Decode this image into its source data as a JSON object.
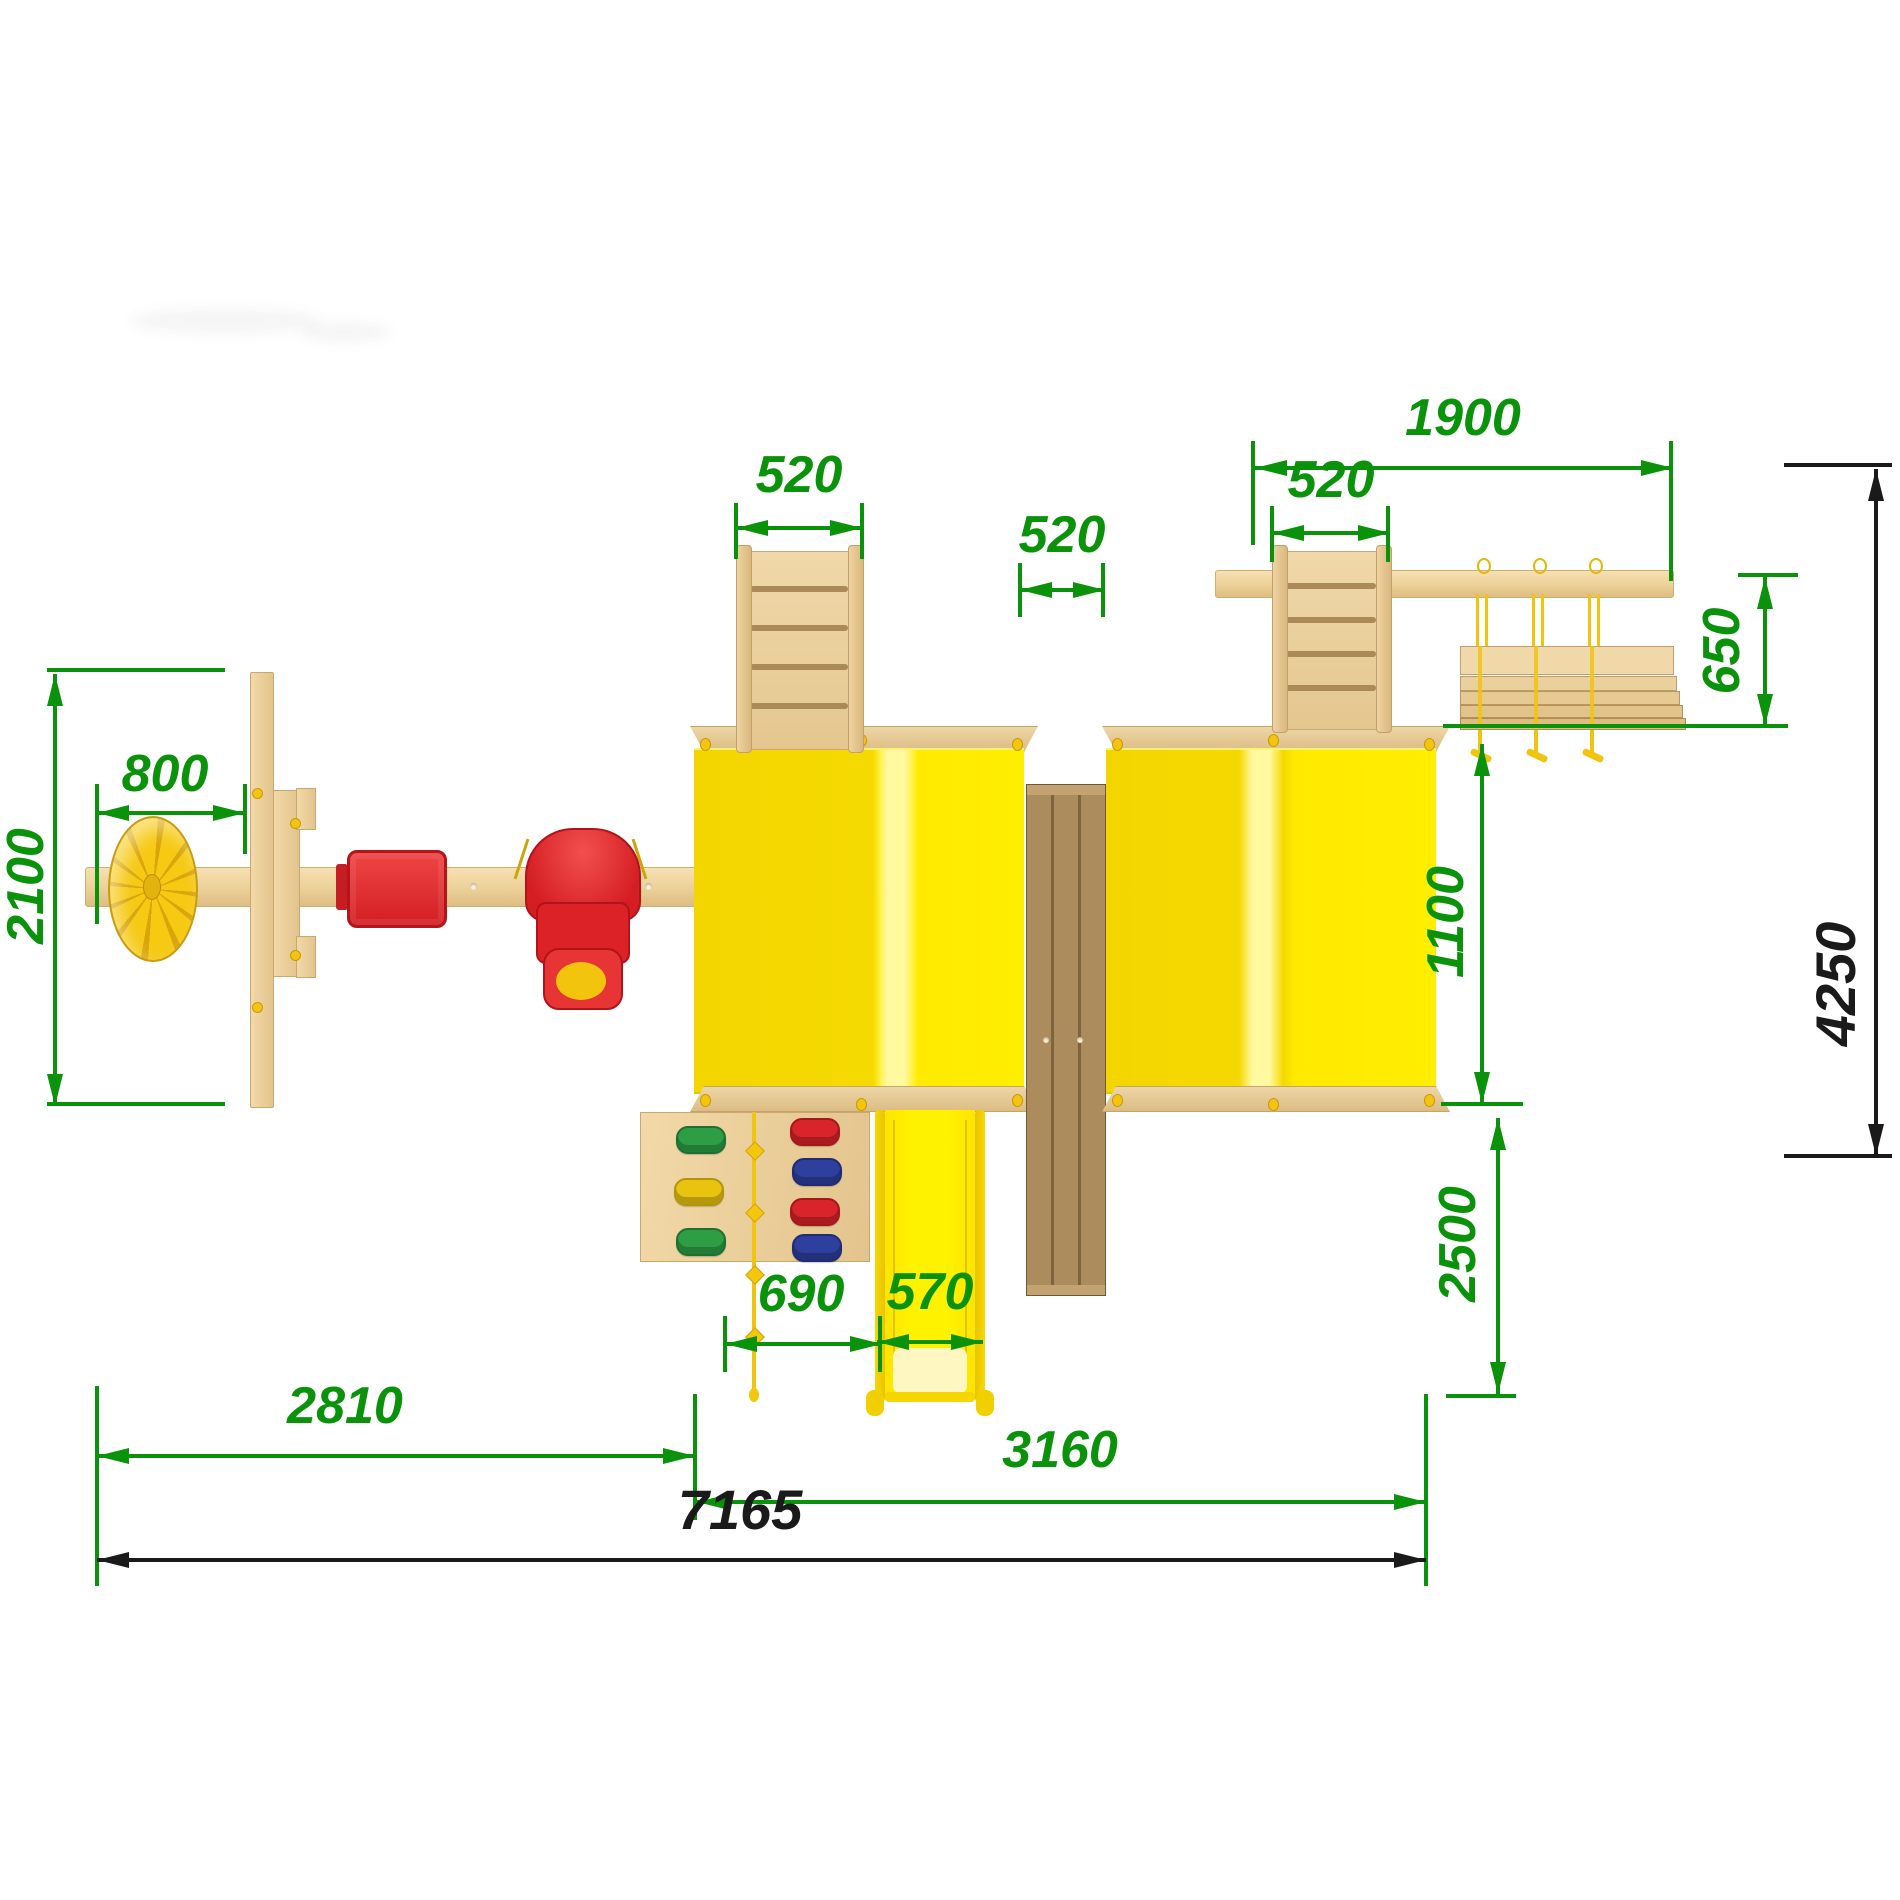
{
  "drawing": {
    "kind": "playground-set top view with dimensions",
    "dimension_units_shown": "mm (numbers only)"
  },
  "dims": {
    "d2100": "2100",
    "d800": "800",
    "d520_left": "520",
    "d520_middle": "520",
    "d520_right": "520",
    "d1900": "1900",
    "d650": "650",
    "d1100": "1100",
    "d2500": "2500",
    "d4250": "4250",
    "d690": "690",
    "d570": "570",
    "d2810": "2810",
    "d3160": "3160",
    "d7165": "7165"
  },
  "colors": {
    "dimension_green": "#0a930a",
    "dimension_black": "#1a1a1a",
    "roof_yellow": "#ffe900",
    "slide_yellow": "#fff200",
    "wood_light": "#eed3a2",
    "wood_dark": "#a98c5c",
    "seat_red": "#dc2127",
    "rope_yellow": "#f1c40f",
    "hold_green": "#2e9e44",
    "hold_blue": "#2e3f9e",
    "hold_red": "#d8242a",
    "hold_yellow": "#e8c411"
  },
  "components": [
    "swing-beam",
    "steering-wheel-disc",
    "swing-frame-post",
    "flat-swing-seat",
    "baby-swing-seat",
    "left-tower-roof",
    "right-tower-roof",
    "entry-ladder",
    "bridge-deck",
    "overhead-beam",
    "hanging-plank-module",
    "climbing-wall",
    "climbing-rope",
    "slide"
  ]
}
